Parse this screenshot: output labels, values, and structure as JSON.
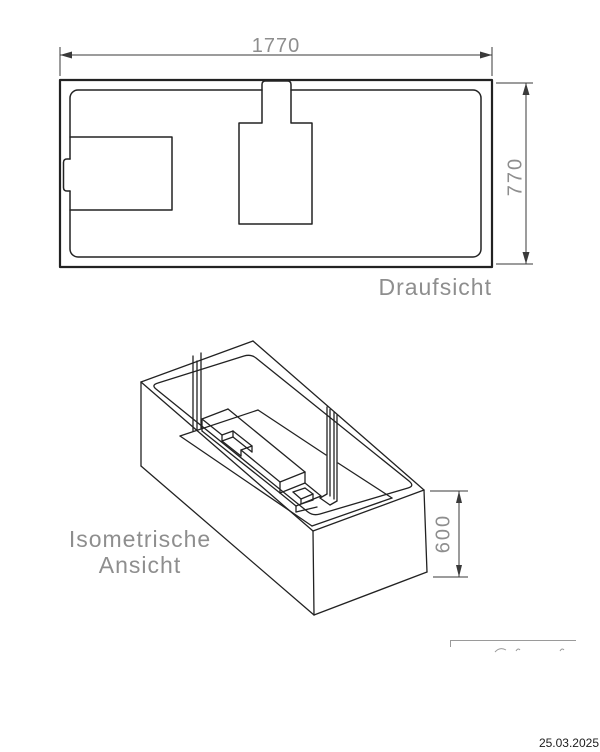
{
  "document": {
    "type": "technical-drawing",
    "views": {
      "top_view": {
        "label": "Draufsicht",
        "width_dim": "1770",
        "height_dim": "770"
      },
      "iso_view": {
        "label_line1": "Isometrische",
        "label_line2": "Ansicht",
        "height_dim": "600"
      }
    },
    "footer": {
      "date": "25.03.2025"
    },
    "colors": {
      "line": "#222222",
      "dimension_line": "#3a3a3a",
      "cad_text": "#8e8e8e",
      "date_text": "#1c1c1c",
      "background": "#ffffff"
    }
  }
}
